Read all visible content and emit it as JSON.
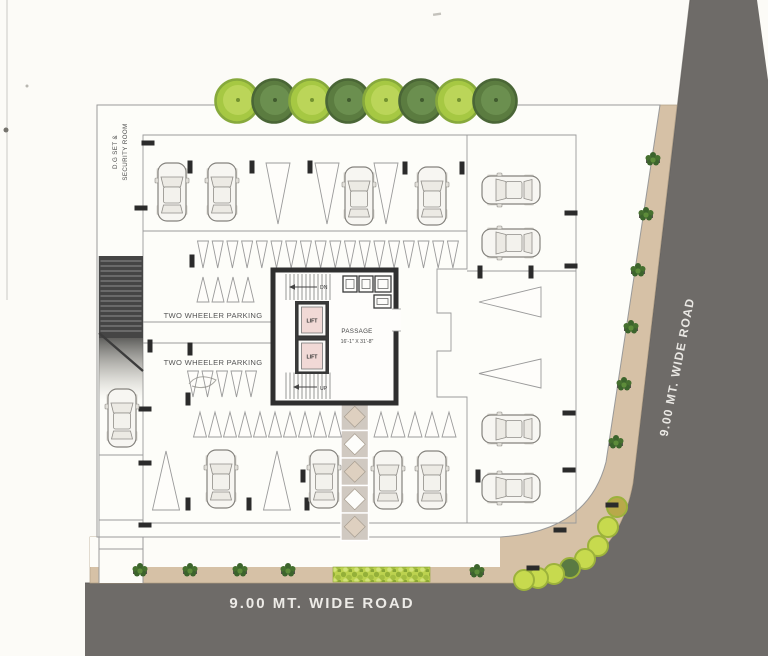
{
  "labels": {
    "dg_room_line1": "D.G SET &",
    "dg_room_line2": "SECURITY ROOM",
    "two_wheeler_parking_1": "TWO WHEELER PARKING",
    "two_wheeler_parking_2": "TWO WHEELER PARKING",
    "lift_upper": "LIFT",
    "lift_lower": "LIFT",
    "passage_line1": "PASSAGE",
    "passage_line2": "16'-1\" X 31'-8\"",
    "stair_down": "DN",
    "stair_up": "UP",
    "road_bottom": "9.00 MT. WIDE ROAD",
    "road_right": "9.00 MT. WIDE ROAD"
  },
  "colors": {
    "road": "#6e6b68",
    "road_edge": "#605d5a",
    "sidewalk": "#d6c1a6",
    "sidewalk_edge": "#b3a188",
    "setback_white": "#fdfcf8",
    "plot_fill": "#fdfdf9",
    "line_thin": "#9a9a9a",
    "wall_dark": "#2f2f2f",
    "ramp_dark": "#454545",
    "ramp_tread": "#8f8f8f",
    "tick_black": "#2b2b2b",
    "tree_light_fill": "#a6c843",
    "tree_light_ring": "#87a93c",
    "tree_light_inner": "#bcd65b",
    "tree_dark_fill": "#5b7c40",
    "tree_dark_ring": "#4a6636",
    "tree_dark_inner": "#6d9050",
    "lift_pink": "#f1d9d6",
    "lift_frame": "#3a3a3a",
    "diamond_tan": "#ded0c0",
    "diamond_bg": "#d0c9c1",
    "hedge_green": "#bcd24f",
    "hedge_dot": "#94b039",
    "bush_green": "#c7da4e",
    "bush_ring": "#9cb23b",
    "bush_dark": "#5a7a42",
    "bush_olive": "#b8a94a",
    "plant_green": "#3c642c",
    "plant_pot": "#55544c",
    "car_body": "#f7f6f2",
    "car_line": "#85837e",
    "car_glass": "#eceae4"
  },
  "counts": {
    "trees_top_row": 8,
    "parked_cars": 13,
    "lifts": 2
  }
}
